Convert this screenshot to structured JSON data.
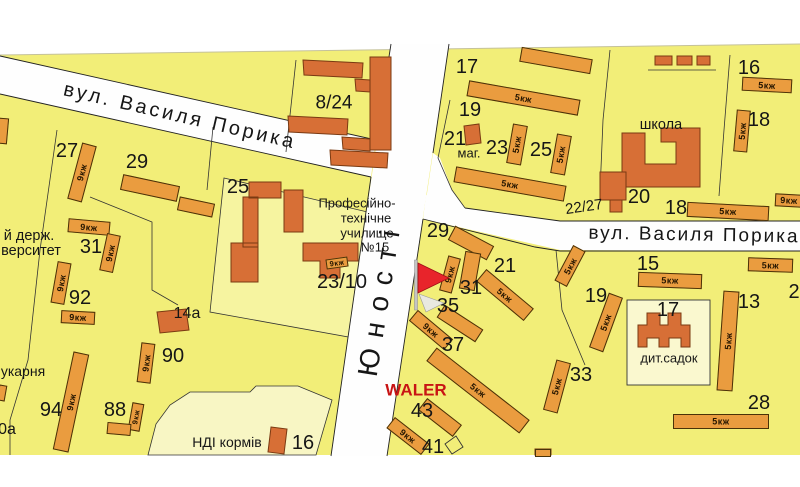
{
  "map": {
    "colors": {
      "map-bg": "#F2EE78",
      "lot-light": "#F6F4A0",
      "lot-cream": "#F8F6C4",
      "street": "#FEFEFE",
      "bar": "#EA9C3F",
      "public": "#D76F36",
      "marker-red": "#E8242B",
      "waler-red": "#C81414",
      "ink": "#161616"
    },
    "streets": [
      {
        "label": "вул. Василя Порика",
        "x": 180,
        "y": 116,
        "fs": 20,
        "rot": 13,
        "ls": 3,
        "name": "street-label-porika-west"
      },
      {
        "label": "вул. Василя Порика",
        "x": 694,
        "y": 235,
        "fs": 19,
        "rot": 1,
        "ls": 2,
        "name": "street-label-porika-east"
      },
      {
        "label": "Юності",
        "x": 380,
        "y": 298,
        "fs": 28,
        "rot": -81,
        "ls": 11,
        "name": "street-label-yunosti"
      }
    ],
    "marker": {
      "caption": "WALER",
      "x": 416,
      "y": 390,
      "fs": 17,
      "name": "map-marker-flag"
    },
    "labels": [
      {
        "t": "27",
        "x": 67,
        "y": 151,
        "fs": 20,
        "name": "label-bldg-27"
      },
      {
        "t": "29",
        "x": 137,
        "y": 162,
        "fs": 20,
        "name": "label-bldg-29-west"
      },
      {
        "t": "25",
        "x": 238,
        "y": 187,
        "fs": 20,
        "name": "label-bldg-25-west"
      },
      {
        "t": "8/24",
        "x": 334,
        "y": 103,
        "fs": 19,
        "name": "label-bldg-8-24"
      },
      {
        "t": "23/10",
        "x": 342,
        "y": 282,
        "fs": 20,
        "name": "label-bldg-23-10"
      },
      {
        "t": "31",
        "x": 91,
        "y": 247,
        "fs": 20,
        "name": "label-bldg-31-west"
      },
      {
        "t": "92",
        "x": 80,
        "y": 298,
        "fs": 20,
        "name": "label-bldg-92"
      },
      {
        "t": "14а",
        "x": 187,
        "y": 314,
        "fs": 16,
        "name": "label-bldg-14a"
      },
      {
        "t": "90",
        "x": 173,
        "y": 356,
        "fs": 20,
        "name": "label-bldg-90"
      },
      {
        "t": "94",
        "x": 51,
        "y": 410,
        "fs": 20,
        "name": "label-bldg-94"
      },
      {
        "t": "88",
        "x": 115,
        "y": 410,
        "fs": 20,
        "name": "label-bldg-88"
      },
      {
        "t": "0а",
        "x": 7,
        "y": 430,
        "fs": 16,
        "name": "label-bldg-0a-partial"
      },
      {
        "t": "16",
        "x": 303,
        "y": 443,
        "fs": 20,
        "name": "label-bldg-16-ndi"
      },
      {
        "t": "17",
        "x": 467,
        "y": 67,
        "fs": 20,
        "name": "label-bldg-17-north"
      },
      {
        "t": "19",
        "x": 470,
        "y": 110,
        "fs": 20,
        "name": "label-bldg-19-north"
      },
      {
        "t": "21",
        "x": 455,
        "y": 139,
        "fs": 20,
        "name": "label-bldg-21-north"
      },
      {
        "t": "23",
        "x": 497,
        "y": 148,
        "fs": 20,
        "name": "label-bldg-23-north"
      },
      {
        "t": "25",
        "x": 541,
        "y": 150,
        "fs": 20,
        "name": "label-bldg-25-north"
      },
      {
        "t": "20",
        "x": 639,
        "y": 197,
        "fs": 20,
        "name": "label-bldg-20"
      },
      {
        "t": "16",
        "x": 749,
        "y": 68,
        "fs": 20,
        "name": "label-bldg-16-ne"
      },
      {
        "t": "18",
        "x": 759,
        "y": 120,
        "fs": 20,
        "name": "label-bldg-18-ne"
      },
      {
        "t": "18",
        "x": 676,
        "y": 208,
        "fs": 20,
        "name": "label-bldg-18-school"
      },
      {
        "t": "22/27",
        "x": 584,
        "y": 207,
        "fs": 15,
        "rot": -8,
        "name": "label-bldg-22-27"
      },
      {
        "t": "29",
        "x": 438,
        "y": 231,
        "fs": 20,
        "name": "label-bldg-29-east"
      },
      {
        "t": "21",
        "x": 505,
        "y": 266,
        "fs": 20,
        "name": "label-bldg-21-east"
      },
      {
        "t": "31",
        "x": 471,
        "y": 288,
        "fs": 20,
        "name": "label-bldg-31-east"
      },
      {
        "t": "35",
        "x": 448,
        "y": 306,
        "fs": 20,
        "name": "label-bldg-35"
      },
      {
        "t": "37",
        "x": 453,
        "y": 345,
        "fs": 20,
        "name": "label-bldg-37"
      },
      {
        "t": "15",
        "x": 648,
        "y": 264,
        "fs": 20,
        "name": "label-bldg-15"
      },
      {
        "t": "19",
        "x": 596,
        "y": 296,
        "fs": 20,
        "name": "label-bldg-19-east"
      },
      {
        "t": "17",
        "x": 668,
        "y": 310,
        "fs": 20,
        "name": "label-bldg-17-sadok"
      },
      {
        "t": "13",
        "x": 749,
        "y": 302,
        "fs": 20,
        "name": "label-bldg-13"
      },
      {
        "t": "33",
        "x": 581,
        "y": 375,
        "fs": 20,
        "name": "label-bldg-33"
      },
      {
        "t": "28",
        "x": 759,
        "y": 403,
        "fs": 20,
        "name": "label-bldg-28"
      },
      {
        "t": "43",
        "x": 422,
        "y": 411,
        "fs": 20,
        "name": "label-bldg-43"
      },
      {
        "t": "41",
        "x": 433,
        "y": 447,
        "fs": 20,
        "name": "label-bldg-41"
      },
      {
        "t": "2",
        "x": 794,
        "y": 292,
        "fs": 20,
        "name": "label-bldg-2-partial"
      },
      {
        "t": "маг.",
        "x": 469,
        "y": 153,
        "fs": 13,
        "name": "poi-label-shop"
      },
      {
        "t": "школа",
        "x": 661,
        "y": 125,
        "fs": 14.5,
        "name": "poi-label-school"
      },
      {
        "t": "дит.садок",
        "x": 669,
        "y": 358,
        "fs": 13,
        "name": "poi-label-kindergarten"
      },
      {
        "t": "НДІ кормів",
        "x": 227,
        "y": 442,
        "fs": 14,
        "name": "poi-label-ndi-kormiv"
      },
      {
        "t": "укарня",
        "x": 23,
        "y": 371,
        "fs": 14,
        "name": "poi-label-bakery-partial"
      },
      {
        "t": "й держ.",
        "x": 29,
        "y": 236,
        "fs": 14.5,
        "name": "poi-label-university-line1"
      },
      {
        "t": "верситет",
        "x": 31,
        "y": 251,
        "fs": 14.5,
        "name": "poi-label-university-line2"
      },
      {
        "t": "Професійно-",
        "x": 357,
        "y": 203,
        "fs": 13,
        "name": "poi-label-vocational-line1"
      },
      {
        "t": "технічне",
        "x": 366,
        "y": 218,
        "fs": 13,
        "name": "poi-label-vocational-line2"
      },
      {
        "t": "училище",
        "x": 367,
        "y": 233,
        "fs": 13,
        "name": "poi-label-vocational-line3"
      },
      {
        "t": "№15",
        "x": 375,
        "y": 247,
        "fs": 13,
        "name": "poi-label-vocational-line4"
      }
    ],
    "bars": [
      {
        "x": 82,
        "y": 172,
        "l": 58,
        "t": 15,
        "r": -75,
        "tag": "9кж",
        "name": "bar-27"
      },
      {
        "x": 150,
        "y": 188,
        "l": 58,
        "t": 16,
        "r": 12,
        "name": "bar-29-west-a"
      },
      {
        "x": 196,
        "y": 207,
        "l": 36,
        "t": 14,
        "r": 12,
        "name": "bar-29-west-b"
      },
      {
        "x": 89,
        "y": 227,
        "l": 42,
        "t": 14,
        "r": 5,
        "tag": "9кж",
        "name": "bar-31-top"
      },
      {
        "x": 110,
        "y": 253,
        "l": 38,
        "t": 14,
        "r": -78,
        "tag": "9кж",
        "name": "bar-31-right"
      },
      {
        "x": 61,
        "y": 283,
        "l": 42,
        "t": 14,
        "r": -80,
        "tag": "9кж",
        "name": "bar-92-left"
      },
      {
        "x": 78,
        "y": 317,
        "l": 34,
        "t": 13,
        "r": 3,
        "tag": "9кж",
        "name": "bar-92-bottom"
      },
      {
        "x": 146,
        "y": 363,
        "l": 40,
        "t": 14,
        "r": -83,
        "tag": "9кж",
        "name": "bar-90"
      },
      {
        "x": 71,
        "y": 402,
        "l": 100,
        "t": 16,
        "r": -78,
        "tag": "9кж",
        "name": "bar-94"
      },
      {
        "x": 136,
        "y": 417,
        "l": 28,
        "t": 12,
        "r": -80,
        "tag": "9кж",
        "name": "bar-88-right"
      },
      {
        "x": 119,
        "y": 429,
        "l": 24,
        "t": 12,
        "r": 5,
        "name": "bar-88-bottom"
      },
      {
        "x": 337,
        "y": 263,
        "l": 22,
        "t": 10,
        "r": -8,
        "tag": "9кж",
        "name": "bar-tag-23-10"
      },
      {
        "x": 3,
        "y": 131,
        "l": 26,
        "t": 10,
        "r": -85,
        "name": "bar-left-edge-partial-a"
      },
      {
        "x": 2,
        "y": 393,
        "l": 16,
        "t": 8,
        "r": -80,
        "name": "bar-left-edge-partial-b"
      },
      {
        "x": 556,
        "y": 60,
        "l": 72,
        "t": 15,
        "r": 10,
        "name": "bar-17-north"
      },
      {
        "x": 523,
        "y": 98,
        "l": 113,
        "t": 16,
        "r": 10,
        "tag": "5кж",
        "name": "bar-19-north"
      },
      {
        "x": 517,
        "y": 144,
        "l": 40,
        "t": 15,
        "r": -80,
        "tag": "5кж",
        "name": "bar-23-north"
      },
      {
        "x": 561,
        "y": 154,
        "l": 40,
        "t": 15,
        "r": -80,
        "tag": "5кж",
        "name": "bar-25-north"
      },
      {
        "x": 510,
        "y": 184,
        "l": 112,
        "t": 16,
        "r": 10,
        "tag": "5кж",
        "name": "bar-row-south"
      },
      {
        "x": 767,
        "y": 85,
        "l": 50,
        "t": 14,
        "r": 3,
        "tag": "5кж",
        "name": "bar-16-ne"
      },
      {
        "x": 742,
        "y": 131,
        "l": 42,
        "t": 14,
        "r": -85,
        "tag": "5кж",
        "name": "bar-18-ne"
      },
      {
        "x": 728,
        "y": 211,
        "l": 82,
        "t": 15,
        "r": 3,
        "tag": "5кж",
        "name": "bar-18-school"
      },
      {
        "x": 789,
        "y": 200,
        "l": 28,
        "t": 13,
        "r": 3,
        "tag": "9кж",
        "name": "bar-right-edge-partial"
      },
      {
        "x": 670,
        "y": 280,
        "l": 64,
        "t": 15,
        "r": 2,
        "tag": "5кж",
        "name": "bar-15"
      },
      {
        "x": 770,
        "y": 265,
        "l": 45,
        "t": 14,
        "r": 2,
        "tag": "5кж",
        "name": "bar-right-of-15"
      },
      {
        "x": 606,
        "y": 322,
        "l": 58,
        "t": 15,
        "r": -70,
        "tag": "5кж",
        "name": "bar-19-east"
      },
      {
        "x": 728,
        "y": 341,
        "l": 100,
        "t": 16,
        "r": -86,
        "tag": "5кж",
        "name": "bar-13"
      },
      {
        "x": 557,
        "y": 386,
        "l": 52,
        "t": 15,
        "r": -75,
        "tag": "5кж",
        "name": "bar-33"
      },
      {
        "x": 721,
        "y": 421,
        "l": 96,
        "t": 15,
        "r": 0,
        "tag": "5кж",
        "name": "bar-28"
      },
      {
        "x": 471,
        "y": 243,
        "l": 44,
        "t": 16,
        "r": 28,
        "name": "bar-29-east-arm"
      },
      {
        "x": 470,
        "y": 271,
        "l": 38,
        "t": 16,
        "r": -80,
        "name": "bar-29-east-leg"
      },
      {
        "x": 450,
        "y": 274,
        "l": 36,
        "t": 13,
        "r": -75,
        "tag": "9кж",
        "name": "bar-tag-29-east"
      },
      {
        "x": 505,
        "y": 295,
        "l": 62,
        "t": 16,
        "r": 40,
        "tag": "5кж",
        "name": "bar-21-east"
      },
      {
        "x": 460,
        "y": 323,
        "l": 46,
        "t": 15,
        "r": 33,
        "name": "bar-35"
      },
      {
        "x": 431,
        "y": 330,
        "l": 46,
        "t": 14,
        "r": 40,
        "tag": "9кж",
        "name": "bar-below-35"
      },
      {
        "x": 478,
        "y": 390,
        "l": 118,
        "t": 17,
        "r": 38,
        "tag": "5кж",
        "name": "bar-37"
      },
      {
        "x": 408,
        "y": 436,
        "l": 44,
        "t": 14,
        "r": 38,
        "tag": "9кж",
        "name": "bar-43"
      },
      {
        "x": 440,
        "y": 417,
        "l": 44,
        "t": 15,
        "r": 38,
        "name": "bar-41-neighbor"
      },
      {
        "x": 570,
        "y": 266,
        "l": 40,
        "t": 14,
        "r": -62,
        "tag": "5кж",
        "name": "bar-west-of-19-east"
      },
      {
        "x": 543,
        "y": 453,
        "l": 16,
        "t": 8,
        "r": 0,
        "name": "bar-bottom-partial"
      }
    ]
  }
}
